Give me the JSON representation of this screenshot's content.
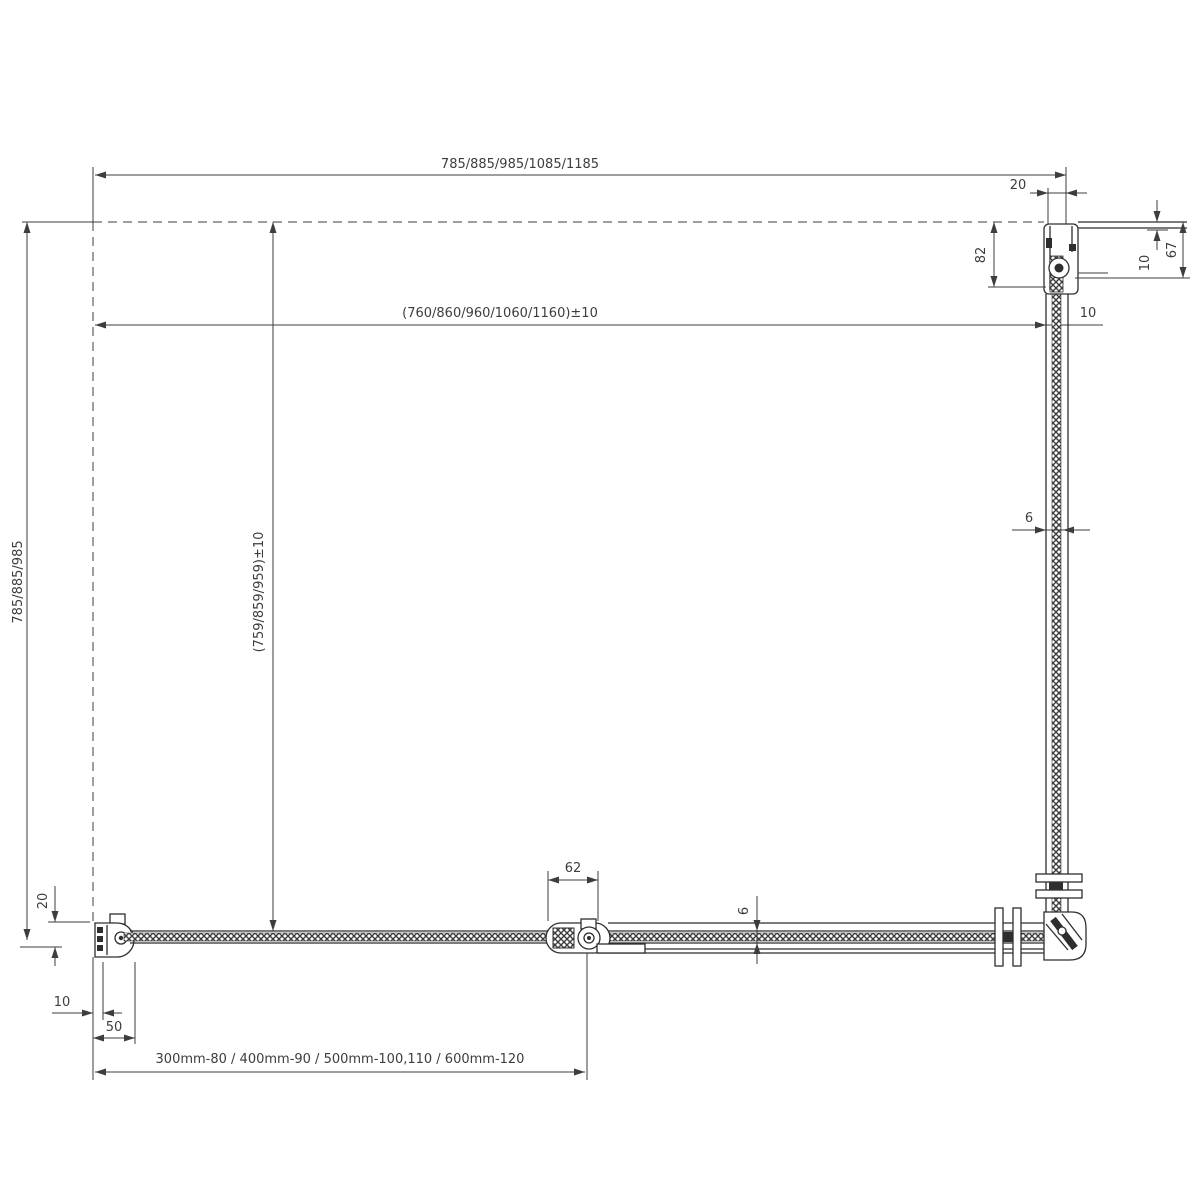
{
  "drawing": {
    "labels": {
      "overall_width": "785/885/985/1085/1185",
      "glass_width": "(760/860/960/1060/1160)±10",
      "glass_width_inset": "10",
      "overall_depth": "785/885/985",
      "glass_depth": "(759/859/959)±10",
      "wall_adjust_top": "20",
      "wall_profile_height": "82",
      "wall_glass_inset": "10",
      "wall_profile_total": "67",
      "glass_thickness_side": "6",
      "glass_thickness_bottom": "6",
      "hinge_width": "62",
      "wall_adjust_left": "20",
      "glass_inset_left": "10",
      "profile_width_left": "50",
      "door_size_table": "300mm-80 / 400mm-90 / 500mm-100,110 / 600mm-120"
    }
  }
}
